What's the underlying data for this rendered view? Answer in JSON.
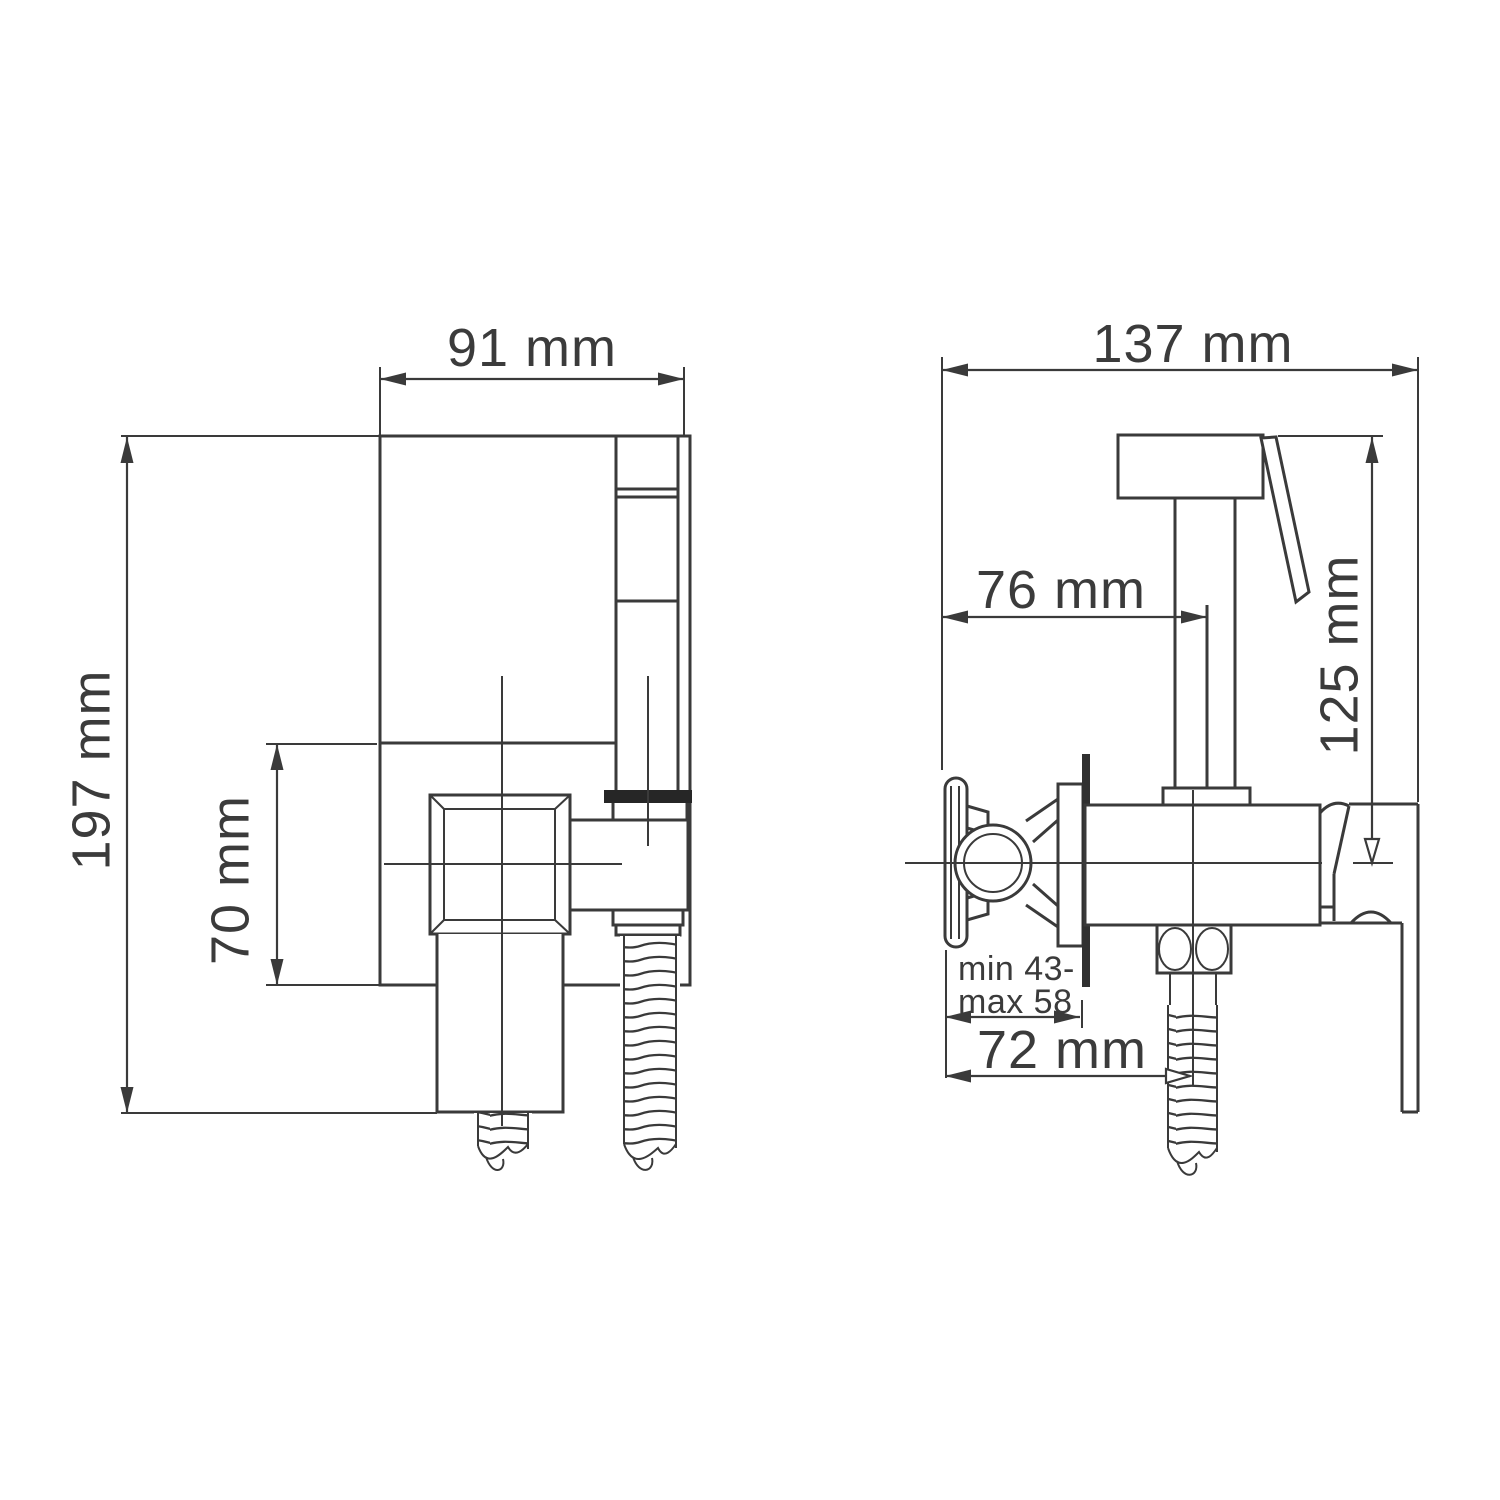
{
  "drawing": {
    "type": "technical dimension drawing",
    "subject": "wall-mounted hygienic shower bidet mixer, two orthographic views",
    "colors": {
      "line": "#3a3a3a",
      "background": "#ffffff",
      "gasket_fill": "#262626",
      "wall_fill": "#303030"
    }
  },
  "front_view": {
    "dim_overall_height": "197 mm",
    "dim_plate_width": "91 mm",
    "dim_valve_axis_offset": "70 mm"
  },
  "side_view": {
    "dim_overall_depth": "137 mm",
    "dim_holder_offset": "76 mm",
    "dim_shower_height": "125 mm",
    "dim_wall_range_line1": "min 43-",
    "dim_wall_range_line2": "max 58",
    "dim_hose_offset": "72 mm"
  }
}
